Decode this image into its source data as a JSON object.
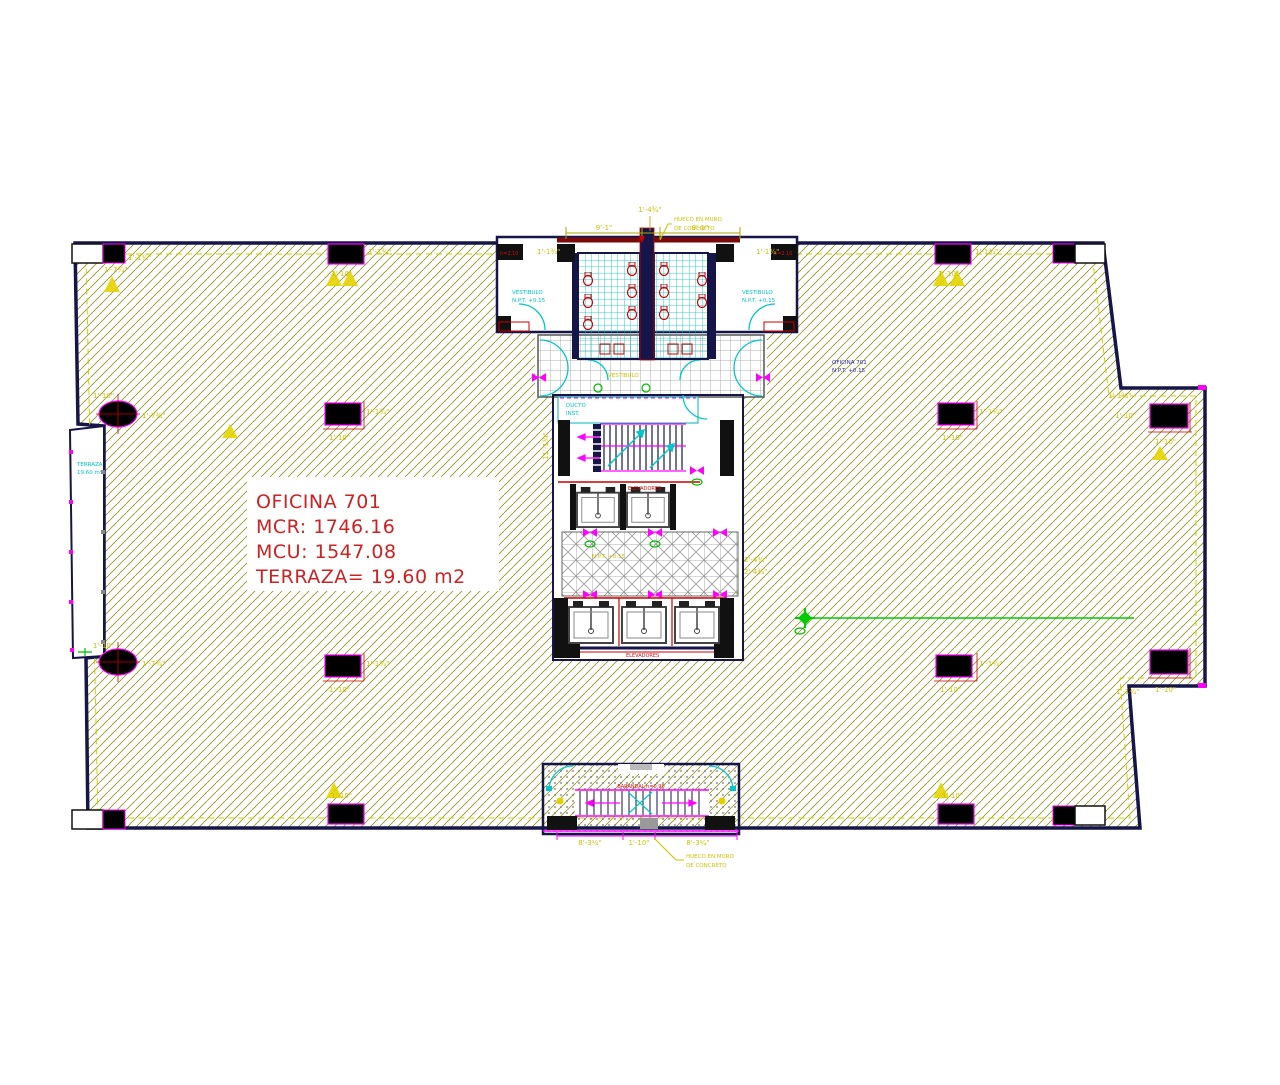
{
  "title_block": {
    "line1": "OFICINA 701",
    "line2": "MCR: 1746.16",
    "line3": "MCU: 1547.08",
    "line4": "TERRAZA= 19.60 m2"
  },
  "annotations": {
    "hueco_line1": "HUECO EN MURO",
    "hueco_line2": "DE CONCRETO",
    "left_terrace_line1": "TERRAZA",
    "left_terrace_line2": "19.60 m²",
    "area_line1": "OFICINA 701",
    "area_line2": "N.P.T. +0.15",
    "vestibule": "VESTIBULO",
    "npt": "N.P.T. +0.15",
    "stair_room_line1": "DUCTO",
    "stair_room_line2": "INST.",
    "elevators_upper": "ELEVADORES",
    "elevators_lower": "ELEVADORES",
    "rail": "BARANDAL h=0.90",
    "wall_block": "h=2.10"
  },
  "dims": {
    "col_w": "1'-10\"",
    "col_h": "1'-1¾\"",
    "round_col": "1'-7¾\"",
    "top_left": "9'-1\"",
    "top_center": "1'-4¾\"",
    "top_right": "9'-1\"",
    "bottom_left": "8'-3¼\"",
    "bottom_center": "1'-10\"",
    "bottom_right": "8'-3¼\"",
    "side": "2'-4¾\"",
    "stair": "11'-1¾\""
  },
  "colors": {
    "wall": "#15154a",
    "hatch": "#96962a",
    "red_text": "#cc2222",
    "magenta": "#ff00ff",
    "cyan": "#00c2c2",
    "yellow": "#cfc000",
    "green": "#00bb00",
    "tile_gray": "#999999"
  }
}
